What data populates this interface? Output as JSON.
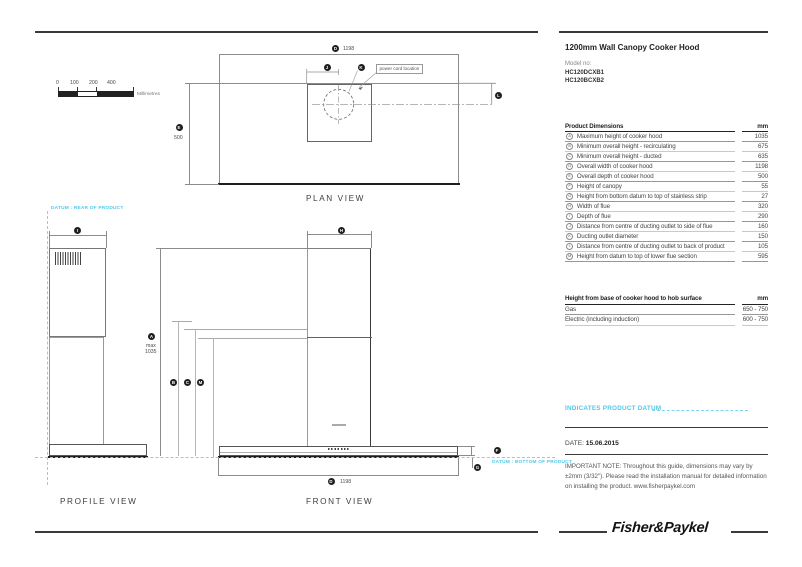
{
  "header": {
    "title": "1200mm Wall Canopy Cooker Hood",
    "model_label": "Model no:",
    "model_1": "HC120DCXB1",
    "model_2": "HC120BCXB2"
  },
  "scale": {
    "t0": "0",
    "t1": "100",
    "t2": "200",
    "t3": "400",
    "unit": "Millimetres"
  },
  "plan": {
    "title": "PLAN VIEW",
    "marker_d": "D",
    "dim_d": "1198",
    "marker_e": "E",
    "dim_e": "500",
    "marker_j": "J",
    "marker_k": "K",
    "marker_l": "L",
    "power_cord_label": "power cord location"
  },
  "profile": {
    "title": "PROFILE VIEW",
    "datum_label": "DATUM : REAR OF PRODUCT",
    "marker_i": "I"
  },
  "front": {
    "title": "FRONT VIEW",
    "datum_label": "DATUM : BOTTOM OF PRODUCT",
    "marker_a": "A",
    "a_prefix": "max",
    "a_value": "1035",
    "marker_b": "B",
    "marker_c": "C",
    "marker_m": "M",
    "marker_h": "H",
    "marker_f": "F",
    "marker_g": "G",
    "marker_d": "D",
    "dim_d": "1198"
  },
  "product_table": {
    "title": "Product Dimensions",
    "unit": "mm",
    "rows": [
      {
        "key": "A",
        "label": "Maximum height of cooker hood",
        "value": "1035"
      },
      {
        "key": "B",
        "label": "Minimum overall height - recirculating",
        "value": "675"
      },
      {
        "key": "C",
        "label": "Minimum overall height - ducted",
        "value": "635"
      },
      {
        "key": "D",
        "label": "Overall width of cooker hood",
        "value": "1198"
      },
      {
        "key": "E",
        "label": "Overall depth of cooker hood",
        "value": "500"
      },
      {
        "key": "F",
        "label": "Height of canopy",
        "value": "55"
      },
      {
        "key": "G",
        "label": "Height from bottom datum to top of stainless strip",
        "value": "27"
      },
      {
        "key": "H",
        "label": "Width of flue",
        "value": "320"
      },
      {
        "key": "I",
        "label": "Depth of flue",
        "value": "290"
      },
      {
        "key": "J",
        "label": "Distance from centre of ducting outlet to side of flue",
        "value": "160"
      },
      {
        "key": "K",
        "label": "Ducting outlet diameter",
        "value": "150"
      },
      {
        "key": "L",
        "label": "Distance from centre of ducting outlet to back of product",
        "value": "105"
      },
      {
        "key": "M",
        "label": "Height from datum to top of lower flue section",
        "value": "595"
      }
    ]
  },
  "hob_table": {
    "title": "Height from base of cooker hood to hob surface",
    "unit": "mm",
    "rows": [
      {
        "label": "Gas",
        "value": "650 - 750"
      },
      {
        "label": "Electric (including induction)",
        "value": "600 - 750"
      }
    ]
  },
  "legend": {
    "indicates_datum": "INDICATES PRODUCT DATUM"
  },
  "footer": {
    "date_label": "DATE:",
    "date_value": "15.06.2015",
    "note": "IMPORTANT NOTE: Throughout this guide, dimensions may vary by ±2mm (3/32\"). Please read the installation manual for detailed information on installing the product. www.fisherpaykel.com",
    "logo": "Fisher&Paykel"
  }
}
